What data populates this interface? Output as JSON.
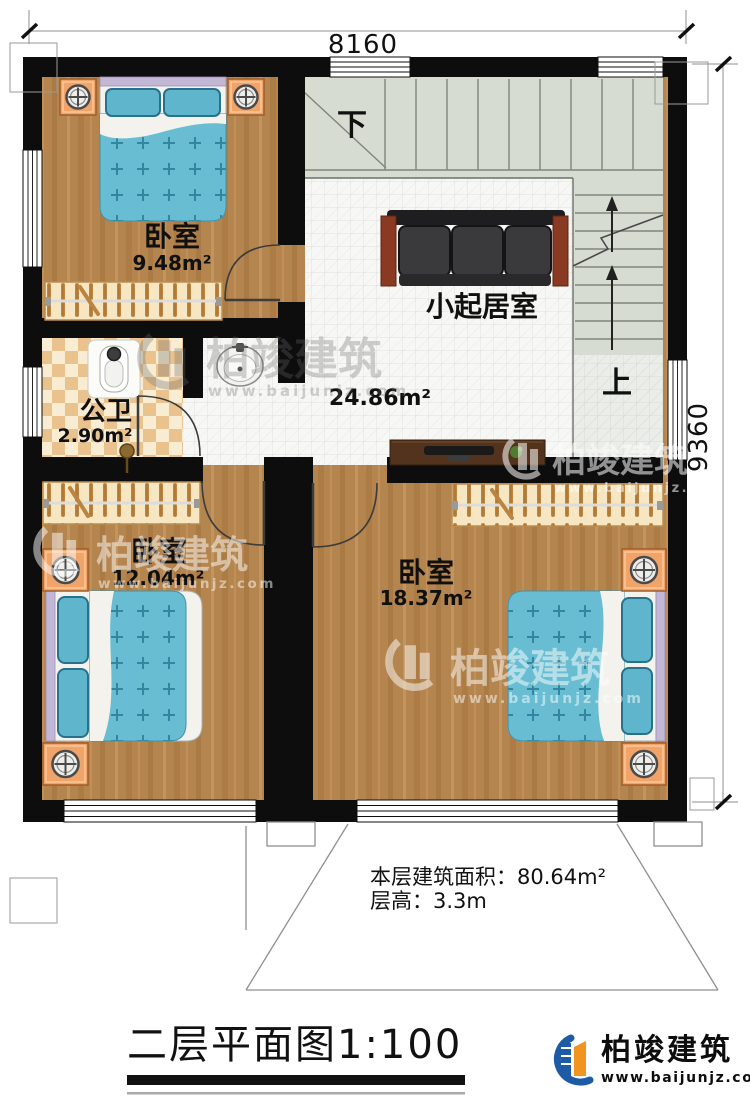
{
  "dimensions": {
    "top": "8160",
    "right": "9360"
  },
  "rooms": {
    "bedroom_top": {
      "name": "卧室",
      "area": "9.48m²"
    },
    "living": {
      "name": "小起居室",
      "area": "24.86m²"
    },
    "bath": {
      "name": "公卫",
      "area": "2.90m²"
    },
    "bedroom_left": {
      "name": "卧室",
      "area": "12.04m²"
    },
    "bedroom_right": {
      "name": "卧室",
      "area": "18.37m²"
    }
  },
  "stairs": {
    "down_label": "下",
    "up_label": "上"
  },
  "notes": {
    "floor_area": "本层建筑面积：80.64m²",
    "floor_height": "层高：3.3m"
  },
  "title": {
    "text": "二层平面图1:100"
  },
  "brand": {
    "name": "柏竣建筑",
    "site": "www.baijunjz.com"
  },
  "watermark": {
    "name": "柏竣建筑",
    "site": "www.baijunjz.com"
  },
  "colors": {
    "wall": "#0d0d0d",
    "wood_floor": "#b5854f",
    "tile_floor": "#f7f7f5",
    "stair_floor": "#d6dcd2",
    "bath_tile_dark": "#eac28e",
    "bed_teal": "#68bdd2",
    "brand_blue": "#1d5ba6",
    "brand_orange": "#f29420"
  }
}
